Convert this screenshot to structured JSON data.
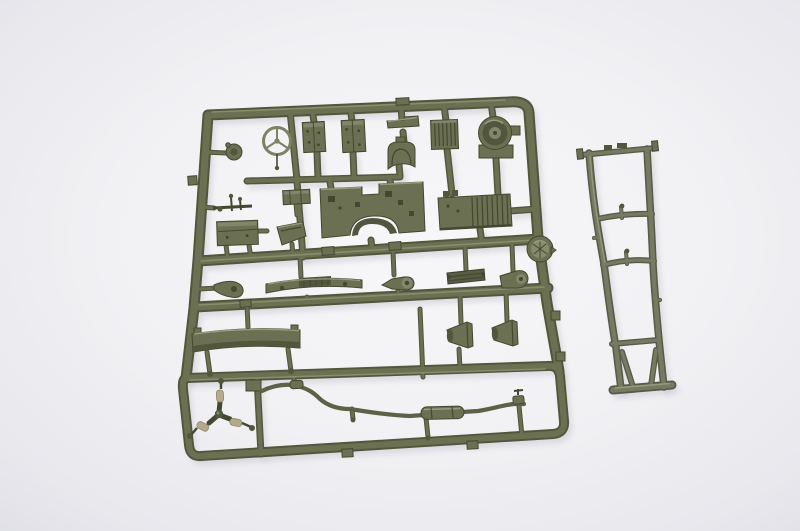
{
  "meta": {
    "type": "photograph",
    "subject": "Olive-green injection-molded plastic model kit sprue with small vehicle parts, plus a separate ladder chassis frame, lying on a bright neutral studio background"
  },
  "palette": {
    "background_center": "#f7f7f9",
    "background_edge": "#dfdfe6",
    "olive_dark": "#434830",
    "olive_shadow": "#51563c",
    "olive_mid": "#6b7052",
    "olive_light": "#82866a",
    "olive_highlight": "#979c7d",
    "gray_olive": "#767a63",
    "gray_olive_dark": "#565a46",
    "tan": "#b4ab8c",
    "shadow": "#c6c6cf"
  },
  "sprues": {
    "main": {
      "label": "main parts sprue",
      "parts": [
        {
          "id": "steering-wheel",
          "desc": "Three-spoke steering wheel"
        },
        {
          "id": "horn-button",
          "desc": "Small round cap part"
        },
        {
          "id": "box-part-a",
          "desc": "Rectangular box part"
        },
        {
          "id": "box-part-b",
          "desc": "Rectangular box part"
        },
        {
          "id": "flat-bar",
          "desc": "Flat bar part"
        },
        {
          "id": "seat-back",
          "desc": "Curved seat back part"
        },
        {
          "id": "radiator-core",
          "desc": "Ribbed radiator core"
        },
        {
          "id": "fan-shroud",
          "desc": "Round fan shroud with bracket"
        },
        {
          "id": "lever-cluster",
          "desc": "Gear lever cluster"
        },
        {
          "id": "tool-box",
          "desc": "Tool box"
        },
        {
          "id": "small-bracket-box",
          "desc": "Small bracket box"
        },
        {
          "id": "wedge-block",
          "desc": "Wedge shaped block"
        },
        {
          "id": "firewall",
          "desc": "Firewall bulkhead with wheel-arch cutout"
        },
        {
          "id": "engine-block",
          "desc": "Ribbed engine and transmission block"
        },
        {
          "id": "reflector-disc",
          "desc": "Round reflector disc at runner junction"
        },
        {
          "id": "leaf-spring",
          "desc": "Leaf spring"
        },
        {
          "id": "pivot-bracket",
          "desc": "Pivot bracket with round boss"
        },
        {
          "id": "windshield-cowl",
          "desc": "Long ribbed cowl strip"
        },
        {
          "id": "pulley-bracket",
          "desc": "Bracket with pulley boss"
        },
        {
          "id": "mount-lug",
          "desc": "Teardrop mounting lug"
        },
        {
          "id": "bumper-band",
          "desc": "Wide curved bumper band"
        },
        {
          "id": "light-bucket-a",
          "desc": "Conical light bucket"
        },
        {
          "id": "light-bucket-b",
          "desc": "Conical light bucket"
        },
        {
          "id": "shock-cluster",
          "desc": "Three shock absorbers on a Y runner"
        },
        {
          "id": "exhaust-pipe",
          "desc": "Winding exhaust pipe with muffler"
        }
      ]
    },
    "chassis": {
      "label": "chassis frame",
      "desc": "Ladder chassis frame with crossmembers and rear bumper bar"
    }
  }
}
